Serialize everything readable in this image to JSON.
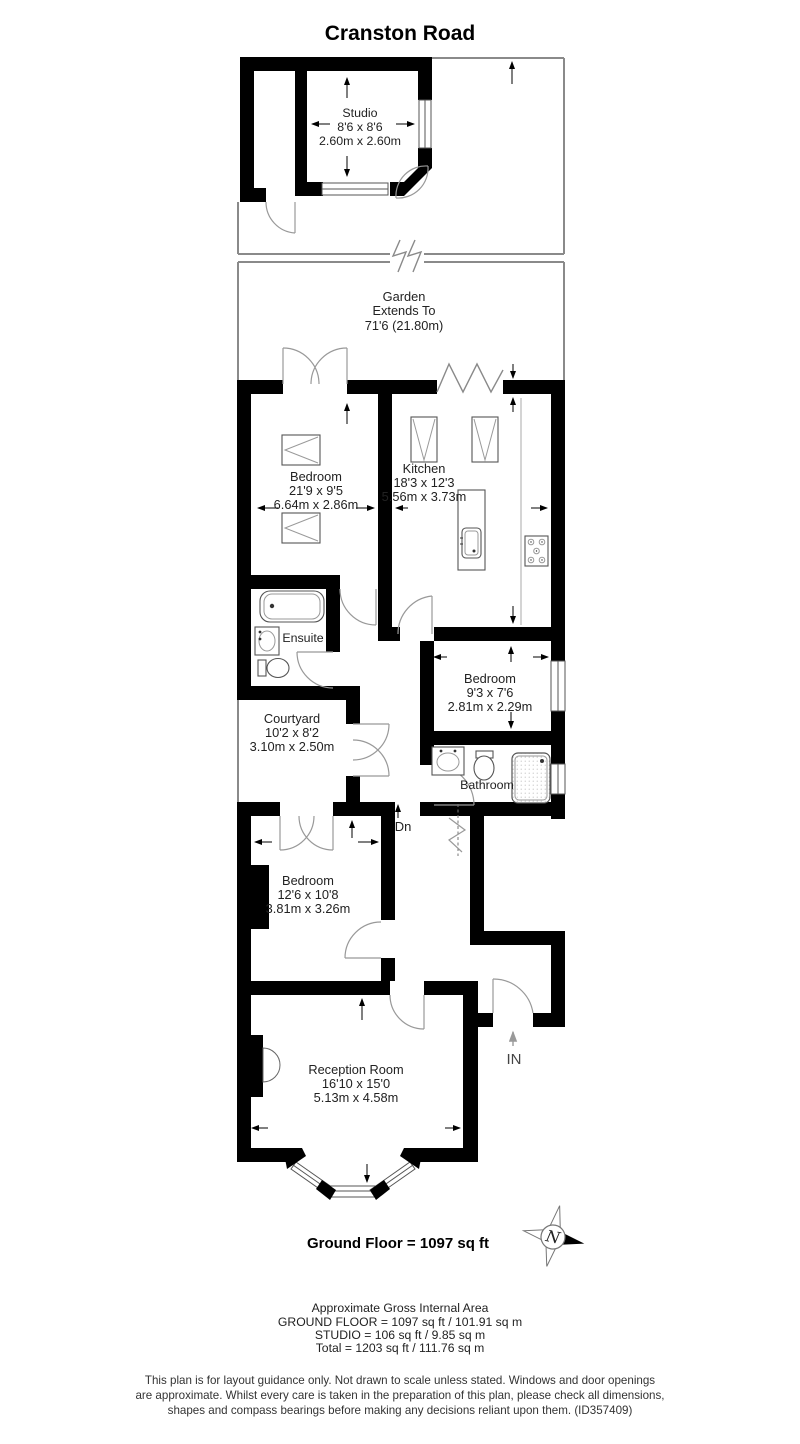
{
  "title": "Cranston Road",
  "plan": {
    "rooms": {
      "studio": {
        "name": "Studio",
        "imperial": "8'6 x 8'6",
        "metric": "2.60m x 2.60m"
      },
      "garden": {
        "name": "Garden",
        "extends": "Extends To",
        "dimension": "71'6 (21.80m)"
      },
      "bedroom_rear": {
        "name": "Bedroom",
        "imperial": "21'9 x 9'5",
        "metric": "6.64m x 2.86m"
      },
      "kitchen": {
        "name": "Kitchen",
        "imperial": "18'3 x 12'3",
        "metric": "5.56m x 3.73m"
      },
      "ensuite": {
        "name": "Ensuite"
      },
      "bedroom_middle": {
        "name": "Bedroom",
        "imperial": "9'3 x 7'6",
        "metric": "2.81m x 2.29m"
      },
      "courtyard": {
        "name": "Courtyard",
        "imperial": "10'2 x 8'2",
        "metric": "3.10m x 2.50m"
      },
      "bathroom": {
        "name": "Bathroom"
      },
      "bedroom_front": {
        "name": "Bedroom",
        "imperial": "12'6 x 10'8",
        "metric": "3.81m x 3.26m"
      },
      "reception": {
        "name": "Reception Room",
        "imperial": "16'10 x 15'0",
        "metric": "5.13m x 4.58m"
      }
    },
    "labels": {
      "stairs_down": "Dn",
      "entrance": "IN",
      "compass_north": "N"
    },
    "floor_total": "Ground Floor = 1097 sq ft"
  },
  "areas": {
    "heading": "Approximate Gross Internal Area",
    "ground_floor": "GROUND FLOOR = 1097 sq ft / 101.91 sq m",
    "studio": "STUDIO = 106 sq ft / 9.85 sq m",
    "total": "Total = 1203 sq ft / 111.76 sq m"
  },
  "disclaimer": {
    "line1": "This plan is for layout guidance only. Not drawn to scale unless stated. Windows and door openings",
    "line2": "are approximate. Whilst every care is taken in the preparation of this plan, please check all dimensions,",
    "line3": "shapes and compass bearings before making any decisions reliant upon them. (ID357409)"
  },
  "colors": {
    "wall": "#000000",
    "outline": "#8a8a8a",
    "door_arc": "#999999",
    "text": "#222222"
  }
}
